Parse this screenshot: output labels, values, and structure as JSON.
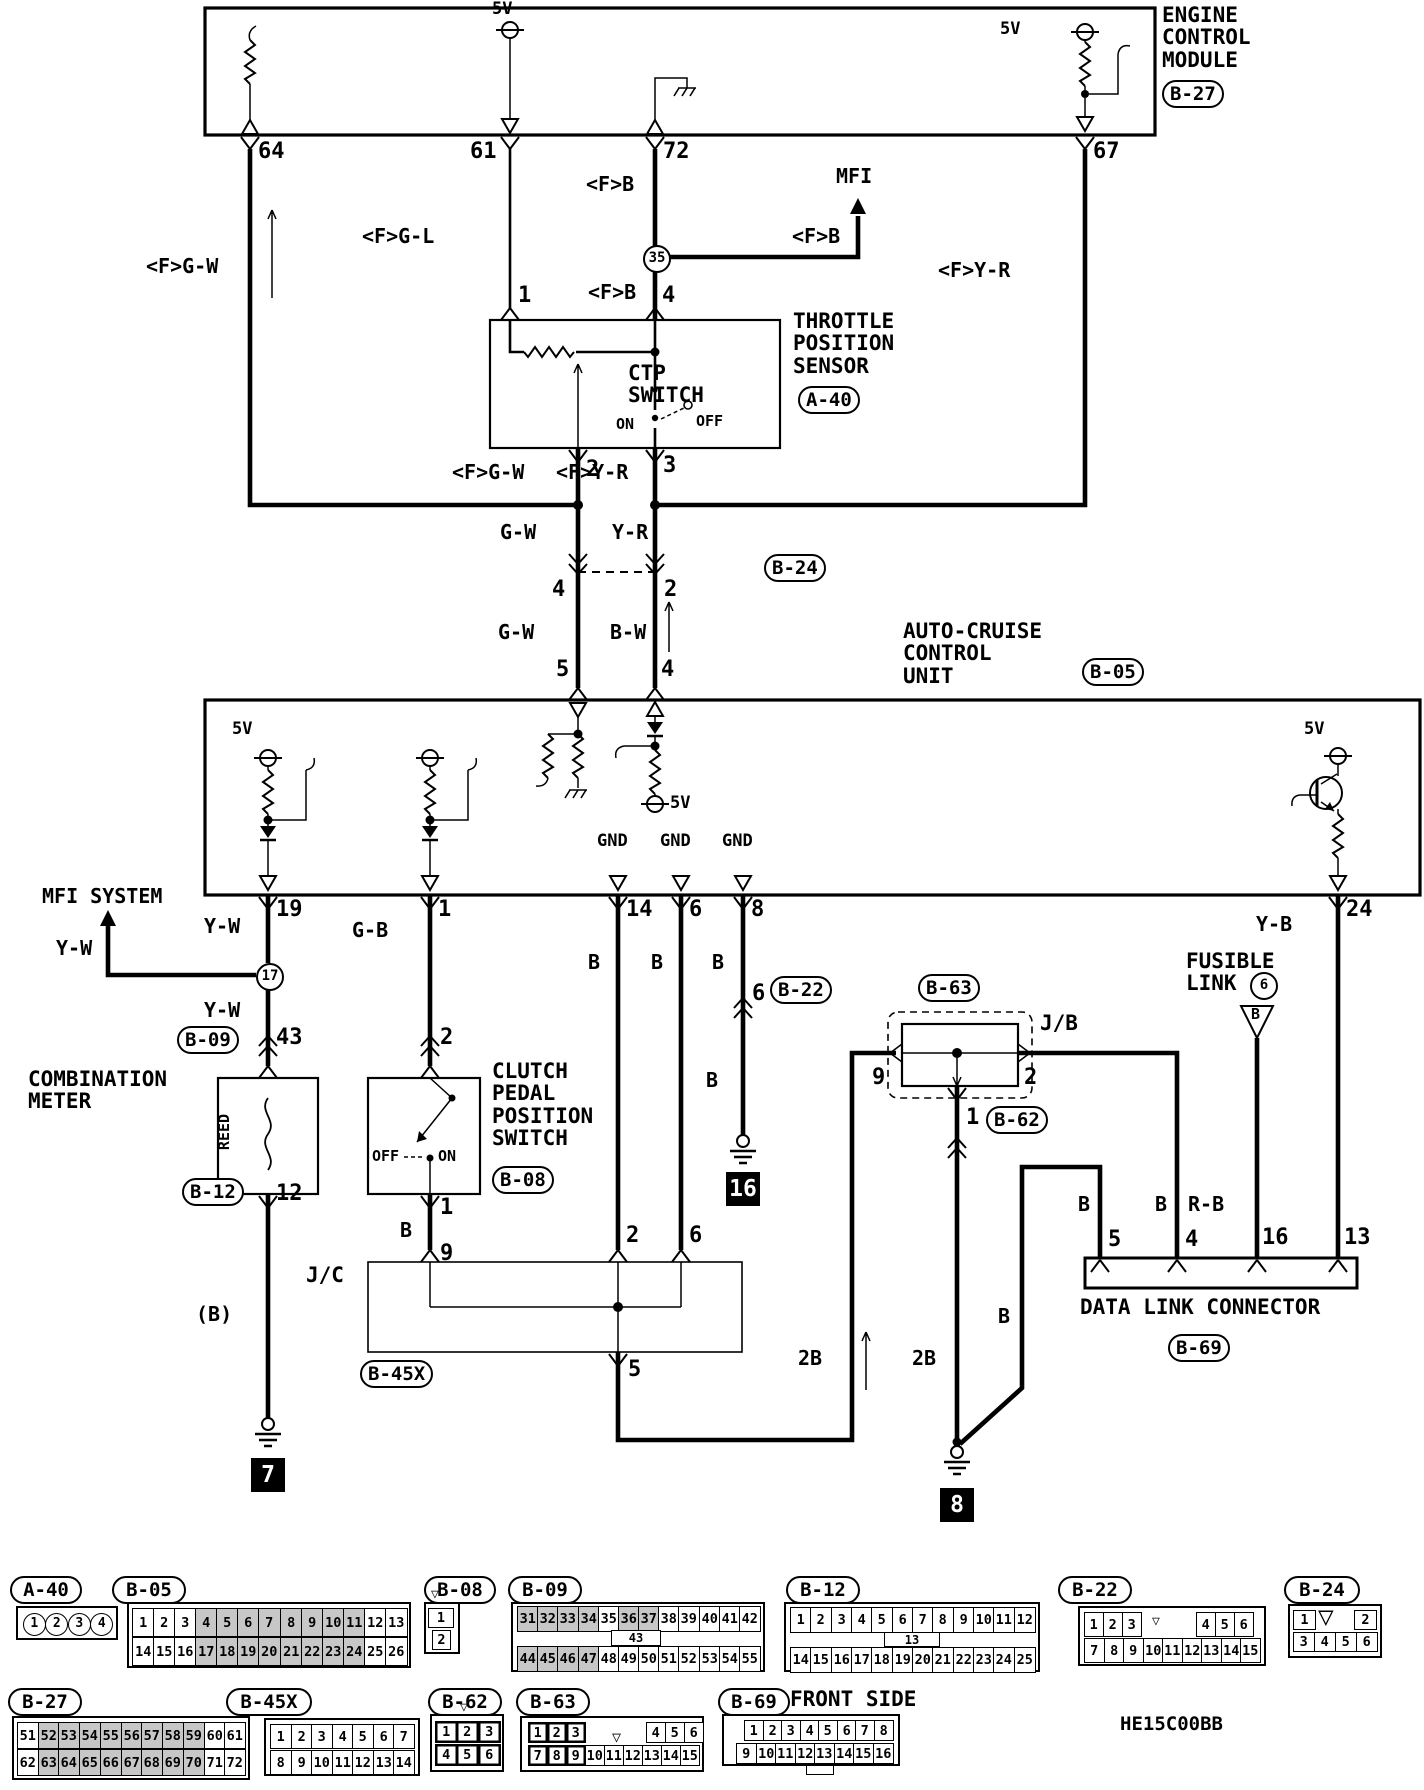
{
  "diagram_code": "HE15C00BB",
  "labels": {
    "ecm_title": "ENGINE\nCONTROL\nMODULE",
    "ecm_code": "B-27",
    "v5_61": "5V",
    "v5_67": "5V",
    "p64": "64",
    "p61": "61",
    "p72": "72",
    "p67": "67",
    "w64": "<F>G-W",
    "w61": "<F>G-L",
    "w72a": "<F>B",
    "w72b": "<F>B",
    "w72c": "<F>B",
    "mfi": "MFI",
    "j35": "35",
    "w67": "<F>Y-R",
    "tps_title": "THROTTLE\nPOSITION\nSENSOR",
    "tps_code": "A-40",
    "ctp": "CTP\nSWITCH",
    "on1": "ON",
    "off1": "OFF",
    "tp1": "1",
    "tp4": "4",
    "tp2": "2",
    "tp3": "3",
    "wfgw2": "<F>G-W",
    "wfyr2": "<F>Y-R",
    "gw1": "G-W",
    "yr1": "Y-R",
    "b24_code": "B-24",
    "b24_4": "4",
    "b24_2": "2",
    "gw2": "G-W",
    "bw": "B-W",
    "cp5": "5",
    "cp4": "4",
    "acc_title": "AUTO-CRUISE\nCONTROL\nUNIT",
    "acc_code": "B-05",
    "v5a": "5V",
    "v5b": "5V",
    "v5c": "5V",
    "gnd1": "GND",
    "gnd2": "GND",
    "gnd3": "GND",
    "p19": "19",
    "pp1": "1",
    "p14": "14",
    "p6": "6",
    "p8": "8",
    "p24": "24",
    "mfisys": "MFI SYSTEM",
    "yw1": "Y-W",
    "yw2": "Y-W",
    "yw3": "Y-W",
    "j17": "17",
    "b09_code": "B-09",
    "p43": "43",
    "comb": "COMBINATION\nMETER",
    "reed": "REED",
    "b12_code": "B-12",
    "p12": "12",
    "wbp": "(B)",
    "g7": "7",
    "wgb": "G-B",
    "cl2": "2",
    "clutch_title": "CLUTCH\nPEDAL\nPOSITION\nSWITCH",
    "b08_code": "B-08",
    "off2": "OFF",
    "on2": "ON",
    "cl1": "1",
    "wb1": "B",
    "cl9": "9",
    "jc": "J/C",
    "b45x_code": "B-45X",
    "jc2": "2",
    "jc6": "6",
    "jc5": "5",
    "wb14": "B",
    "wb6": "B",
    "wb8": "B",
    "b22_code": "B-22",
    "b22_6": "6",
    "wb8b": "B",
    "g16": "16",
    "b63_code": "B-63",
    "jb": "J/B",
    "jb9": "9",
    "jb2": "2",
    "jb1": "1",
    "b62_code": "B-62",
    "w2b1": "2B",
    "w2b2": "2B",
    "wbg": "B",
    "g8": "8",
    "fus": "FUSIBLE\nLINK",
    "fus6": "6",
    "fusb": "B",
    "yb": "Y-B",
    "wbd5": "B",
    "wbd4": "B",
    "rb": "R-B",
    "d5": "5",
    "d4": "4",
    "d16": "16",
    "d13": "13",
    "dlc": "DATA LINK CONNECTOR",
    "b69_code": "B-69",
    "front": "FRONT SIDE",
    "he": "HE15C00BB"
  },
  "connectors": [
    {
      "id": "a40",
      "label": "A-40",
      "oval": [
        10,
        1576,
        56
      ],
      "body": [
        16,
        1606,
        102,
        34
      ],
      "type": "circles",
      "rows": [
        [
          1,
          2,
          3,
          4
        ]
      ]
    },
    {
      "id": "b05",
      "label": "B-05",
      "oval": [
        112,
        1576,
        58
      ],
      "body": [
        127,
        1602,
        284,
        66
      ],
      "type": "grid",
      "pad": 5,
      "rowy": [
        6,
        35
      ],
      "rowh": 29,
      "rows": [
        [
          1,
          2,
          3,
          4,
          5,
          6,
          7,
          8,
          9,
          10,
          11,
          12,
          13
        ],
        [
          14,
          15,
          16,
          17,
          18,
          19,
          20,
          21,
          22,
          23,
          24,
          25,
          26
        ]
      ],
      "shaded": [
        4,
        5,
        6,
        7,
        8,
        9,
        10,
        11,
        17,
        18,
        19,
        20,
        21,
        22,
        23,
        24
      ]
    },
    {
      "id": "b08",
      "label": "B-08",
      "oval": [
        424,
        1576,
        56
      ],
      "body": [
        424,
        1602,
        36,
        52
      ],
      "type": "b08",
      "rows": [
        [
          1
        ],
        [
          2
        ]
      ],
      "extras": [
        {
          "g": "▽",
          "x": 431,
          "y": 1588,
          "fs": 13
        }
      ]
    },
    {
      "id": "b09",
      "label": "B-09",
      "oval": [
        508,
        1576,
        58
      ],
      "body": [
        511,
        1602,
        254,
        70
      ],
      "type": "grid",
      "pad": 6,
      "rowy": [
        4,
        44
      ],
      "rowh": 26,
      "rows": [
        [
          31,
          32,
          33,
          34,
          35,
          36,
          37,
          38,
          39,
          40,
          41,
          42
        ],
        [
          44,
          45,
          46,
          47,
          48,
          49,
          50,
          51,
          52,
          53,
          54,
          55
        ]
      ],
      "shaded": [
        31,
        32,
        33,
        34,
        36,
        37,
        44,
        45,
        46,
        47
      ],
      "mid": {
        "n": 43,
        "x": 611,
        "y": 1630,
        "w": 50,
        "h": 16
      }
    },
    {
      "id": "b12",
      "label": "B-12",
      "oval": [
        786,
        1576,
        58
      ],
      "body": [
        784,
        1602,
        256,
        70
      ],
      "type": "grid",
      "pad": 6,
      "rowy": [
        5,
        45
      ],
      "rowh": 26,
      "rows": [
        [
          1,
          2,
          3,
          4,
          5,
          6,
          7,
          8,
          9,
          10,
          11,
          12
        ],
        [
          14,
          15,
          16,
          17,
          18,
          19,
          20,
          21,
          22,
          23,
          24,
          25
        ]
      ],
      "mid": {
        "n": 13,
        "x": 884,
        "y": 1632,
        "w": 56,
        "h": 15
      }
    },
    {
      "id": "b22",
      "label": "B-22",
      "oval": [
        1058,
        1576,
        58
      ],
      "body": [
        1078,
        1606,
        188,
        60
      ],
      "type": "b22",
      "groups": [
        [
          1,
          2,
          3
        ],
        [
          4,
          5,
          6
        ]
      ],
      "bottom": [
        7,
        8,
        9,
        10,
        11,
        12,
        13,
        14,
        15
      ],
      "extras": [
        {
          "g": "▽",
          "x": 1152,
          "y": 1615,
          "fs": 13
        }
      ]
    },
    {
      "id": "b24",
      "label": "B-24",
      "oval": [
        1284,
        1576,
        60
      ],
      "body": [
        1288,
        1604,
        94,
        54
      ],
      "type": "b24",
      "top": [
        1,
        2
      ],
      "bottom": [
        3,
        4,
        5,
        6
      ],
      "extras": [
        {
          "g": "▽",
          "x": 1318,
          "y": 1604,
          "fs": 26
        }
      ]
    },
    {
      "id": "b27",
      "label": "B-27",
      "oval": [
        8,
        1688,
        58
      ],
      "body": [
        12,
        1716,
        238,
        64
      ],
      "type": "grid",
      "pad": 5,
      "rowy": [
        6,
        33
      ],
      "rowh": 27,
      "rows": [
        [
          51,
          52,
          53,
          54,
          55,
          56,
          57,
          58,
          59,
          60,
          61
        ],
        [
          62,
          63,
          64,
          65,
          66,
          67,
          68,
          69,
          70,
          71,
          72
        ]
      ],
      "shaded": [
        52,
        53,
        54,
        55,
        56,
        57,
        58,
        59,
        63,
        64,
        65,
        66,
        67,
        68,
        69,
        70
      ]
    },
    {
      "id": "b45x",
      "label": "B-45X",
      "oval": [
        226,
        1688,
        70
      ],
      "body": [
        264,
        1718,
        156,
        58
      ],
      "type": "grid",
      "pad": 6,
      "rowy": [
        6,
        32
      ],
      "rowh": 25,
      "rows": [
        [
          1,
          2,
          3,
          4,
          5,
          6,
          7
        ],
        [
          8,
          9,
          10,
          11,
          12,
          13,
          14
        ]
      ]
    },
    {
      "id": "b62",
      "label": "B-62",
      "oval": [
        428,
        1688,
        58
      ],
      "body": [
        430,
        1714,
        74,
        58
      ],
      "type": "grid",
      "pad": 5,
      "rowy": [
        7,
        30
      ],
      "rowh": 22,
      "boldAll": true,
      "rows": [
        [
          1,
          2,
          3
        ],
        [
          4,
          5,
          6
        ]
      ],
      "extras": [
        {
          "g": "▽",
          "x": 460,
          "y": 1701,
          "fs": 13
        }
      ]
    },
    {
      "id": "b63",
      "label": "B-63",
      "oval": [
        516,
        1688,
        58
      ],
      "body": [
        520,
        1716,
        184,
        56
      ],
      "type": "b63",
      "cw": 19,
      "ch": 21,
      "blocks": [
        {
          "cells": [
            1,
            2,
            3
          ],
          "x": 528,
          "y": 1722,
          "bold": true
        },
        {
          "cells": [
            4,
            5,
            6
          ],
          "x": 646,
          "y": 1722
        },
        {
          "cells": [
            7,
            8,
            9
          ],
          "x": 528,
          "y": 1745,
          "bold": true
        },
        {
          "cells": [
            10,
            11,
            12,
            13,
            14,
            15
          ],
          "x": 585,
          "y": 1745
        }
      ],
      "extras": [
        {
          "g": "▽",
          "x": 612,
          "y": 1730,
          "fs": 15
        }
      ]
    },
    {
      "id": "b69",
      "label": "B-69",
      "oval": [
        718,
        1688,
        56
      ],
      "body": [
        722,
        1714,
        178,
        52
      ],
      "type": "b69",
      "ch": 21,
      "rows": [
        {
          "cells": [
            1,
            2,
            3,
            4,
            5,
            6,
            7,
            8
          ],
          "x": 744,
          "y": 1720,
          "cw": 18.5
        },
        {
          "cells": [
            9,
            10,
            11,
            12,
            13,
            14,
            15,
            16
          ],
          "x": 736,
          "y": 1743,
          "cw": 19.5
        }
      ]
    }
  ]
}
